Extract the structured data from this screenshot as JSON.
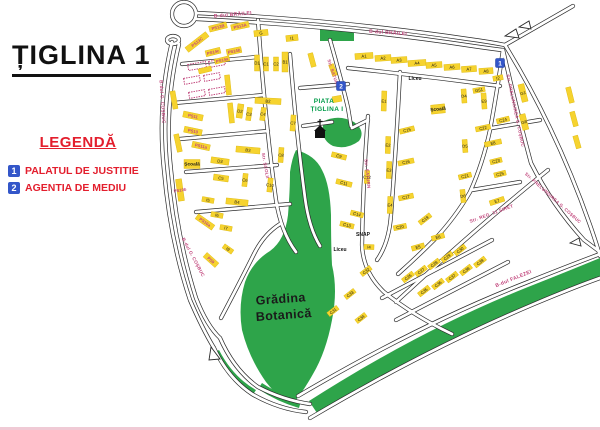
{
  "title": "ȚIGLINA 1",
  "legend": {
    "heading": "LEGENDĂ",
    "items": [
      {
        "num": "1",
        "label": "PALATUL DE JUSTITIE"
      },
      {
        "num": "2",
        "label": "AGENTIA DE MEDIU"
      }
    ]
  },
  "colors": {
    "block": "#f6d32f",
    "block_stroke": "#dcb708",
    "green": "#2ea44a",
    "street": "#c2477d",
    "road": "#2b2b2b",
    "red": "#e31e2d",
    "blue": "#3356c9",
    "piata": "#009b48",
    "text": "#1a1a1a"
  },
  "map": {
    "roads": [
      "M197,13 Q340,20 468,39 Q490,42 505,45",
      "M197,19 Q340,26 466,45 Q486,48 502,50",
      "M505,45 L573,6",
      "M505,45 Q556,128 590,225 Q597,245 600,256",
      "M503,50 Q518,115 531,163 Q552,205 584,240 L600,252",
      "M172,42 Q157,105 164,170 Q170,240 190,300 Q202,328 214,348",
      "M179,44 Q164,107 171,170 Q177,238 196,298 Q207,326 220,338",
      "M214,348 Q228,378 252,394 Q278,409 306,412",
      "M220,338 Q234,370 258,387 Q283,400 310,404",
      "M298,396 Q420,324 528,282 Q568,266 600,254",
      "M310,418 Q425,350 534,304 Q572,288 600,278",
      "M330,40 Q342,82 348,108 L351,126",
      "M368,116 Q363,180 362,245 Q363,272 384,292 Q414,316 452,334",
      "M396,302 Q450,252 502,208 Q528,186 548,170",
      "M503,50 Q497,92 490,130 Q483,163 470,192 Q455,218 434,240 Q416,258 398,274",
      "M258,20 Q265,120 276,200 Q281,232 296,252",
      "M290,54 Q296,130 305,198 Q309,228 320,246",
      "M400,72 Q396,150 391,215 Q389,243 377,260",
      "M182,64 L257,57",
      "M174,103 L264,95",
      "M180,139 L268,131",
      "M186,172 L277,165",
      "M196,212 L290,204",
      "M300,88 L348,84",
      "M303,126 L332,122",
      "M348,68 Q424,76 500,86",
      "M492,128 L540,120",
      "M472,190 L520,182",
      "M382,298 L492,240",
      "M396,320 L508,262",
      "M221,318 Q240,282 254,254 Q264,234 280,224",
      "M352,128 L368,120",
      "M172,14 a12,12 0 1,0 24,0 a12,12 0 1,0 -24,0",
      "M167,40 a6,4 0 1,0 12,0 a6,4 0 1,0 -12,0"
    ],
    "islands": [
      "M505,36 l11,-7 l3,9 z",
      "M519,27 l10,-6 l2,8 z",
      "M570,243 l9,-5 l2,8 z",
      "M211,347 l9,12 l-11,1 z"
    ],
    "green": [
      "M320,29 h34 v12 h-34 Z",
      "M324,121 Q339,114 354,122 Q366,131 359,141 Q347,150 333,146 Q319,139 324,121 Z",
      "M296,150 Q315,155 322,170 Q330,185 331,215 Q331,245 332,265 Q338,290 332,320 Q326,352 313,374 Q303,392 292,405 Q281,401 266,382 Q249,358 242,330 Q238,305 245,282 Q252,262 270,251 Q285,240 288,215 Q290,190 290,172 Q292,158 296,150 Z",
      "M309,401 Q420,330 528,287 Q566,272 600,258 L600,276 Q568,288 532,303 Q424,348 317,413 Z",
      "M219,350 Q233,377 256,390 L252,396 Q230,382 214,353 Z",
      "M262,383 Q282,396 301,401 L299,408 Q278,402 258,389 Z"
    ],
    "dashed": [
      [
        197,
        66,
        18,
        6,
        -10
      ],
      [
        217,
        63,
        16,
        6,
        -10
      ],
      [
        192,
        80,
        16,
        6,
        -10
      ],
      [
        212,
        77,
        16,
        6,
        -10
      ],
      [
        197,
        94,
        16,
        6,
        -10
      ],
      [
        217,
        91,
        16,
        6,
        -10
      ]
    ],
    "blocks": [
      [
        "PS13C",
        197,
        42,
        26,
        6,
        -38,
        1
      ],
      [
        "PS13B",
        218,
        27,
        18,
        6,
        -14,
        1
      ],
      [
        "PS13A",
        240,
        26,
        18,
        6,
        -12,
        1
      ],
      [
        "PS14c",
        213,
        52,
        15,
        6,
        -14,
        1
      ],
      [
        "PS14b",
        234,
        51,
        15,
        6,
        -12,
        1
      ],
      [
        "PS14a",
        222,
        60,
        15,
        5,
        -14,
        1
      ],
      [
        "PS11",
        193,
        116,
        20,
        6,
        12,
        1
      ],
      [
        "PS10",
        193,
        131,
        18,
        6,
        12,
        1
      ],
      [
        "PS11a",
        201,
        146,
        18,
        6,
        12,
        1
      ],
      [
        "PS10b",
        180,
        190,
        6,
        22,
        -8,
        1
      ],
      [
        "PS10a",
        205,
        222,
        20,
        6,
        35,
        1
      ],
      [
        "PS9",
        211,
        260,
        16,
        6,
        42,
        1
      ],
      [
        "",
        174,
        100,
        5,
        18,
        -10,
        0
      ],
      [
        "",
        178,
        143,
        5,
        18,
        -12,
        0
      ],
      [
        "",
        228,
        85,
        5,
        20,
        -6,
        0
      ],
      [
        "",
        231,
        113,
        5,
        20,
        -6,
        0
      ],
      [
        "",
        205,
        70,
        13,
        5,
        -14,
        0
      ],
      [
        "Școală",
        192,
        164,
        16,
        9,
        0,
        2
      ],
      [
        "D3",
        220,
        161,
        18,
        6,
        8,
        0
      ],
      [
        "C5",
        221,
        178,
        15,
        6,
        8,
        0
      ],
      [
        "I5",
        208,
        200,
        12,
        5,
        10,
        0
      ],
      [
        "B4",
        237,
        202,
        22,
        6,
        6,
        0
      ],
      [
        "I6",
        217,
        215,
        12,
        5,
        10,
        0
      ],
      [
        "I7",
        226,
        228,
        12,
        5,
        10,
        0
      ],
      [
        "I9",
        228,
        249,
        11,
        5,
        35,
        0
      ],
      [
        "G",
        261,
        33,
        14,
        6,
        -6,
        0
      ],
      [
        "I1",
        292,
        38,
        12,
        6,
        -6,
        0
      ],
      [
        "D1",
        257,
        63,
        5,
        16,
        0,
        0
      ],
      [
        "C1",
        266,
        64,
        5,
        14,
        0,
        0
      ],
      [
        "C2",
        276,
        64,
        5,
        14,
        0,
        0
      ],
      [
        "B1",
        285,
        62,
        6,
        20,
        0,
        0
      ],
      [
        "B2",
        268,
        101,
        26,
        6,
        3,
        0
      ],
      [
        "D2",
        240,
        111,
        6,
        14,
        8,
        0
      ],
      [
        "C3",
        249,
        114,
        5,
        13,
        8,
        0
      ],
      [
        "C4",
        263,
        114,
        5,
        13,
        8,
        0
      ],
      [
        "C7",
        293,
        123,
        5,
        16,
        4,
        0
      ],
      [
        "B3",
        248,
        150,
        24,
        6,
        5,
        0
      ],
      [
        "C8",
        281,
        155,
        5,
        15,
        4,
        0
      ],
      [
        "C6",
        245,
        180,
        5,
        13,
        6,
        0
      ],
      [
        "C10",
        270,
        185,
        5,
        14,
        6,
        0
      ],
      [
        "C9",
        339,
        156,
        15,
        5,
        14,
        0
      ],
      [
        "C11",
        344,
        183,
        16,
        5,
        14,
        0
      ],
      [
        "C12",
        367,
        177,
        5,
        13,
        2,
        0
      ],
      [
        "C13",
        347,
        225,
        14,
        5,
        14,
        0
      ],
      [
        "C14",
        357,
        214,
        13,
        5,
        14,
        0
      ],
      [
        "I4",
        369,
        247,
        10,
        5,
        2,
        0
      ],
      [
        "E1",
        384,
        101,
        5,
        20,
        2,
        0
      ],
      [
        "E2",
        388,
        145,
        5,
        17,
        2,
        0
      ],
      [
        "E3",
        389,
        170,
        5,
        17,
        2,
        0
      ],
      [
        "E4",
        390,
        205,
        5,
        17,
        2,
        0
      ],
      [
        "C15",
        407,
        130,
        15,
        5,
        -14,
        0
      ],
      [
        "C16",
        406,
        162,
        16,
        5,
        -12,
        0
      ],
      [
        "C17",
        406,
        197,
        15,
        5,
        -12,
        0
      ],
      [
        "C19",
        425,
        219,
        14,
        5,
        -38,
        0
      ],
      [
        "C20",
        400,
        227,
        13,
        5,
        -12,
        0
      ],
      [
        "E5",
        418,
        247,
        13,
        5,
        -16,
        0
      ],
      [
        "E6",
        438,
        237,
        13,
        5,
        -16,
        0
      ],
      [
        "A1",
        364,
        56,
        18,
        6,
        -4,
        0
      ],
      [
        "A2",
        383,
        58,
        16,
        6,
        -4,
        0
      ],
      [
        "A3",
        399,
        60,
        16,
        6,
        -4,
        0
      ],
      [
        "A4",
        417,
        63,
        18,
        6,
        -4,
        0
      ],
      [
        "A5",
        434,
        65,
        16,
        6,
        -4,
        0
      ],
      [
        "A6",
        452,
        67,
        16,
        6,
        -4,
        0
      ],
      [
        "A7",
        469,
        69,
        15,
        6,
        -4,
        0
      ],
      [
        "A8",
        486,
        71,
        14,
        6,
        -4,
        0
      ],
      [
        "I2",
        498,
        78,
        10,
        5,
        -10,
        0
      ],
      [
        "G51",
        479,
        90,
        12,
        5,
        -10,
        0
      ],
      [
        "D4",
        464,
        96,
        5,
        14,
        -4,
        0
      ],
      [
        "E9",
        484,
        101,
        5,
        16,
        -4,
        0
      ],
      [
        "Școală",
        438,
        109,
        14,
        9,
        -6,
        2
      ],
      [
        "G1",
        523,
        93,
        6,
        18,
        -14,
        0
      ],
      [
        "G8",
        524,
        122,
        6,
        16,
        -14,
        0
      ],
      [
        "C24",
        503,
        120,
        13,
        5,
        -14,
        0
      ],
      [
        "C22",
        483,
        128,
        15,
        5,
        -12,
        0
      ],
      [
        "E8",
        493,
        143,
        17,
        5,
        -12,
        0
      ],
      [
        "D5",
        465,
        146,
        5,
        13,
        -4,
        0
      ],
      [
        "C23",
        496,
        161,
        12,
        5,
        -14,
        0
      ],
      [
        "C21",
        465,
        176,
        13,
        5,
        -14,
        0
      ],
      [
        "C25",
        500,
        174,
        12,
        5,
        -14,
        0
      ],
      [
        "D6",
        463,
        196,
        5,
        13,
        -6,
        0
      ],
      [
        "E7",
        497,
        201,
        15,
        5,
        -18,
        0
      ],
      [
        "",
        570,
        95,
        5,
        16,
        -14,
        0
      ],
      [
        "",
        574,
        119,
        5,
        15,
        -15,
        0
      ],
      [
        "",
        577,
        142,
        5,
        13,
        -16,
        0
      ],
      [
        "C26",
        408,
        277,
        13,
        5,
        -38,
        0
      ],
      [
        "C27",
        421,
        271,
        13,
        5,
        -38,
        0
      ],
      [
        "C28",
        434,
        264,
        13,
        5,
        -38,
        0
      ],
      [
        "C29",
        447,
        257,
        13,
        5,
        -38,
        0
      ],
      [
        "C30",
        460,
        250,
        13,
        5,
        -38,
        0
      ],
      [
        "C35",
        424,
        291,
        13,
        5,
        -38,
        0
      ],
      [
        "C36",
        438,
        284,
        13,
        5,
        -38,
        0
      ],
      [
        "C37",
        452,
        277,
        13,
        5,
        -38,
        0
      ],
      [
        "C38",
        466,
        270,
        13,
        5,
        -38,
        0
      ],
      [
        "C39",
        480,
        262,
        13,
        5,
        -38,
        0
      ],
      [
        "C31",
        333,
        311,
        12,
        5,
        -38,
        0
      ],
      [
        "C32",
        366,
        271,
        12,
        5,
        -38,
        0
      ],
      [
        "C33",
        350,
        294,
        12,
        5,
        -38,
        0
      ],
      [
        "C34",
        361,
        318,
        12,
        5,
        -38,
        0
      ],
      [
        "",
        333,
        70,
        5,
        12,
        -20,
        0
      ],
      [
        "",
        337,
        99,
        9,
        6,
        -10,
        0
      ],
      [
        "",
        312,
        60,
        5,
        14,
        -15,
        0
      ]
    ],
    "streets": [
      [
        "B-dul BRĂILEI",
        233,
        16,
        -5,
        5
      ],
      [
        "B-dul BRĂILEI",
        388,
        34,
        4,
        5
      ],
      [
        "B-dul G. COȘBUC",
        161,
        102,
        86,
        4.6
      ],
      [
        "B-dul G. COȘBUC",
        192,
        258,
        62,
        4.6
      ],
      [
        "Str. PRELUNGIREA G. COȘBUC",
        514,
        111,
        78,
        4.4
      ],
      [
        "Str. PRELUNGIREA G. COȘBUC",
        552,
        199,
        42,
        4.4
      ],
      [
        "Str. REG. 11 SIRET",
        492,
        215,
        -20,
        4.6
      ],
      [
        "B-dul FALEZEI",
        514,
        280,
        -22,
        5
      ],
      [
        "Str. SATURN",
        332,
        74,
        72,
        4.4
      ],
      [
        "Str. SATURN",
        366,
        174,
        84,
        4.4
      ],
      [
        "Str. ȘCOLII",
        264,
        166,
        80,
        4.4
      ]
    ],
    "pois": [
      [
        "Liceu",
        415,
        80
      ],
      [
        "Liceu",
        340,
        251
      ],
      [
        "SNAP",
        363,
        236
      ]
    ],
    "areas": [
      [
        "PIATA",
        324,
        103,
        6.5,
        "piata",
        0
      ],
      [
        "ȚIGLINA I",
        327,
        111,
        6.5,
        "piata",
        0
      ],
      [
        "Grădina",
        281,
        303,
        12.5,
        "text",
        -4
      ],
      [
        "Botanică",
        284,
        319,
        12.5,
        "text",
        -4
      ]
    ],
    "markers": [
      {
        "num": "1",
        "x": 500,
        "y": 63
      },
      {
        "num": "2",
        "x": 341,
        "y": 86
      }
    ],
    "church": {
      "x": 320,
      "y": 133
    }
  }
}
